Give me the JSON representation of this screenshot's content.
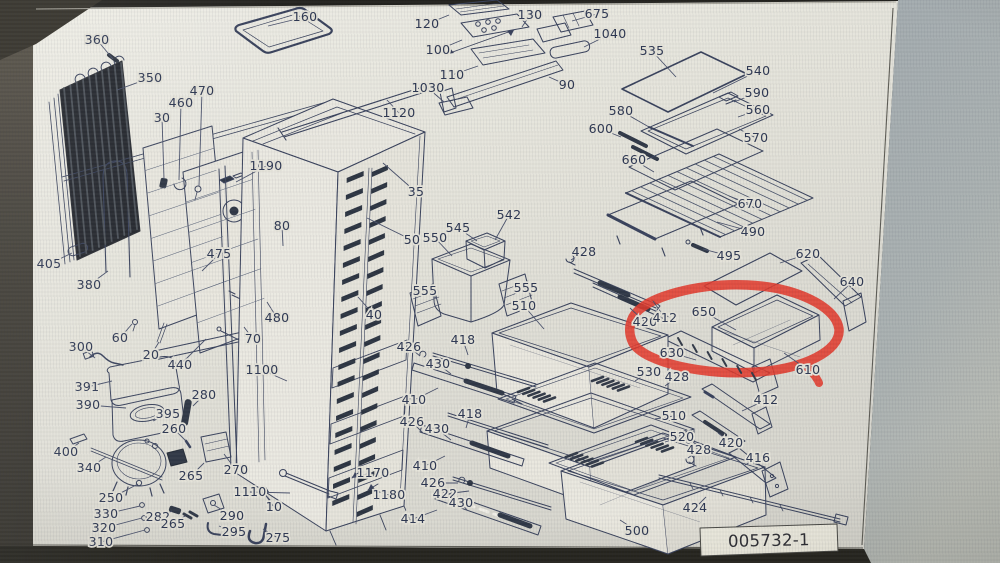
{
  "page": {
    "drawing_number": "005732-1"
  },
  "highlight": {
    "circled_part": "650",
    "color": "#e23a2c"
  },
  "colors": {
    "ink": "#39425c",
    "label_text": "#2d3752",
    "page_paper": "#e7e5dc",
    "wall": "#aab1b3",
    "bezel": "#2a2924"
  },
  "part_labels": [
    {
      "t": "360",
      "x": 97,
      "y": 40,
      "ex": 113,
      "ey": 59
    },
    {
      "t": "350",
      "x": 150,
      "y": 78,
      "ex": 117,
      "ey": 90
    },
    {
      "t": "160",
      "x": 305,
      "y": 17,
      "ex": 268,
      "ey": 26
    },
    {
      "t": "30",
      "x": 162,
      "y": 118,
      "ex": 164,
      "ey": 179
    },
    {
      "t": "460",
      "x": 181,
      "y": 103,
      "ex": 179,
      "ey": 180
    },
    {
      "t": "470",
      "x": 202,
      "y": 91,
      "ex": 199,
      "ey": 186
    },
    {
      "t": "1190",
      "x": 266,
      "y": 166,
      "ex": 236,
      "ey": 182
    },
    {
      "t": "1120",
      "x": 399,
      "y": 113,
      "ex": 387,
      "ey": 100
    },
    {
      "t": "120",
      "x": 427,
      "y": 24,
      "ex": 449,
      "ey": 15
    },
    {
      "t": "100",
      "x": 438,
      "y": 50,
      "ex": 462,
      "ey": 40
    },
    {
      "t": "110",
      "x": 452,
      "y": 75,
      "ex": 478,
      "ey": 66
    },
    {
      "t": "1030",
      "x": 428,
      "y": 88,
      "ex": 444,
      "ey": 102
    },
    {
      "t": "130",
      "x": 530,
      "y": 15,
      "ex": 522,
      "ey": 27
    },
    {
      "t": "675",
      "x": 597,
      "y": 14,
      "ex": 572,
      "ey": 21
    },
    {
      "t": "1040",
      "x": 610,
      "y": 34,
      "ex": 584,
      "ey": 47
    },
    {
      "t": "90",
      "x": 567,
      "y": 85,
      "ex": 549,
      "ey": 77
    },
    {
      "t": "535",
      "x": 652,
      "y": 51,
      "ex": 676,
      "ey": 77
    },
    {
      "t": "540",
      "x": 758,
      "y": 71,
      "ex": 713,
      "ey": 93
    },
    {
      "t": "590",
      "x": 757,
      "y": 93,
      "ex": 734,
      "ey": 102
    },
    {
      "t": "560",
      "x": 758,
      "y": 110,
      "ex": 738,
      "ey": 117
    },
    {
      "t": "580",
      "x": 621,
      "y": 111,
      "ex": 649,
      "ey": 127
    },
    {
      "t": "600",
      "x": 601,
      "y": 129,
      "ex": 621,
      "ey": 137
    },
    {
      "t": "570",
      "x": 756,
      "y": 138,
      "ex": 739,
      "ey": 129
    },
    {
      "t": "660",
      "x": 634,
      "y": 160,
      "ex": 654,
      "ey": 172
    },
    {
      "t": "670",
      "x": 750,
      "y": 204,
      "ex": 729,
      "ey": 196
    },
    {
      "t": "490",
      "x": 753,
      "y": 232,
      "ex": 717,
      "ey": 222
    },
    {
      "t": "495",
      "x": 729,
      "y": 256,
      "ex": 703,
      "ey": 249
    },
    {
      "t": "620",
      "x": 808,
      "y": 254,
      "ex": 780,
      "ey": 263
    },
    {
      "t": "640",
      "x": 852,
      "y": 282,
      "ex": 834,
      "ey": 299
    },
    {
      "t": "650",
      "x": 704,
      "y": 312,
      "ex": 736,
      "ey": 330
    },
    {
      "t": "630",
      "x": 672,
      "y": 353,
      "ex": 696,
      "ey": 360
    },
    {
      "t": "610",
      "x": 808,
      "y": 370,
      "ex": 784,
      "ey": 353
    },
    {
      "t": "35",
      "x": 416,
      "y": 192,
      "ex": 383,
      "ey": 163
    },
    {
      "t": "50",
      "x": 412,
      "y": 240,
      "ex": 367,
      "ey": 218
    },
    {
      "t": "40",
      "x": 374,
      "y": 315,
      "ex": 358,
      "ey": 297
    },
    {
      "t": "80",
      "x": 282,
      "y": 226,
      "ex": 283,
      "ey": 246
    },
    {
      "t": "480",
      "x": 277,
      "y": 318,
      "ex": 267,
      "ey": 302
    },
    {
      "t": "70",
      "x": 253,
      "y": 339,
      "ex": 244,
      "ey": 327
    },
    {
      "t": "1100",
      "x": 262,
      "y": 370,
      "ex": 287,
      "ey": 381
    },
    {
      "t": "1170",
      "x": 373,
      "y": 473,
      "ex": 352,
      "ey": 477
    },
    {
      "t": "1180",
      "x": 389,
      "y": 495,
      "ex": 370,
      "ey": 489
    },
    {
      "t": "405",
      "x": 49,
      "y": 264,
      "ex": 72,
      "ey": 253
    },
    {
      "t": "380",
      "x": 89,
      "y": 285,
      "ex": 108,
      "ey": 271
    },
    {
      "t": "475",
      "x": 219,
      "y": 254,
      "ex": 202,
      "ey": 271
    },
    {
      "t": "300",
      "x": 81,
      "y": 347,
      "ex": 95,
      "ey": 358
    },
    {
      "t": "60",
      "x": 120,
      "y": 338,
      "ex": 132,
      "ey": 324
    },
    {
      "t": "20",
      "x": 151,
      "y": 355,
      "ex": 159,
      "ey": 342
    },
    {
      "t": "440",
      "x": 180,
      "y": 365,
      "ex": 206,
      "ey": 339
    },
    {
      "t": "391",
      "x": 87,
      "y": 387,
      "ex": 112,
      "ey": 381
    },
    {
      "t": "390",
      "x": 88,
      "y": 405,
      "ex": 126,
      "ey": 408
    },
    {
      "t": "395",
      "x": 168,
      "y": 414,
      "ex": 153,
      "ey": 421
    },
    {
      "t": "280",
      "x": 204,
      "y": 395,
      "ex": 193,
      "ey": 406
    },
    {
      "t": "260",
      "x": 174,
      "y": 429,
      "ex": 186,
      "ey": 441
    },
    {
      "t": "400",
      "x": 66,
      "y": 452,
      "ex": 79,
      "ey": 443
    },
    {
      "t": "340",
      "x": 89,
      "y": 468,
      "ex": 106,
      "ey": 457
    },
    {
      "t": "265",
      "x": 191,
      "y": 476,
      "ex": 204,
      "ey": 463
    },
    {
      "t": "270",
      "x": 236,
      "y": 470,
      "ex": 224,
      "ey": 454
    },
    {
      "t": "250",
      "x": 111,
      "y": 498,
      "ex": 138,
      "ey": 484
    },
    {
      "t": "330",
      "x": 106,
      "y": 514,
      "ex": 140,
      "ey": 506
    },
    {
      "t": "320",
      "x": 104,
      "y": 528,
      "ex": 142,
      "ey": 518
    },
    {
      "t": "310",
      "x": 101,
      "y": 542,
      "ex": 145,
      "ey": 530
    },
    {
      "t": "282",
      "x": 158,
      "y": 517,
      "ex": 172,
      "ey": 511
    },
    {
      "t": "265",
      "x": 173,
      "y": 524,
      "ex": 185,
      "ey": 516
    },
    {
      "t": "290",
      "x": 232,
      "y": 516,
      "ex": 214,
      "ey": 505
    },
    {
      "t": "295",
      "x": 234,
      "y": 532,
      "ex": 219,
      "ey": 526
    },
    {
      "t": "1110",
      "x": 250,
      "y": 492,
      "ex": 290,
      "ey": 493
    },
    {
      "t": "10",
      "x": 274,
      "y": 507,
      "ex": 264,
      "ey": 493
    },
    {
      "t": "275",
      "x": 278,
      "y": 538,
      "ex": 263,
      "ey": 529
    },
    {
      "t": "545",
      "x": 458,
      "y": 228,
      "ex": 477,
      "ey": 241
    },
    {
      "t": "550",
      "x": 435,
      "y": 238,
      "ex": 452,
      "ey": 256
    },
    {
      "t": "542",
      "x": 509,
      "y": 215,
      "ex": 495,
      "ey": 240
    },
    {
      "t": "555",
      "x": 425,
      "y": 291,
      "ex": 436,
      "ey": 298
    },
    {
      "t": "555",
      "x": 526,
      "y": 288,
      "ex": 514,
      "ey": 294
    },
    {
      "t": "510",
      "x": 524,
      "y": 306,
      "ex": 544,
      "ey": 329
    },
    {
      "t": "428",
      "x": 584,
      "y": 252,
      "ex": 571,
      "ey": 260
    },
    {
      "t": "420",
      "x": 645,
      "y": 322,
      "ex": 630,
      "ey": 308
    },
    {
      "t": "412",
      "x": 665,
      "y": 318,
      "ex": 653,
      "ey": 301
    },
    {
      "t": "418",
      "x": 463,
      "y": 340,
      "ex": 468,
      "ey": 355
    },
    {
      "t": "426",
      "x": 409,
      "y": 347,
      "ex": 420,
      "ey": 356
    },
    {
      "t": "430",
      "x": 438,
      "y": 364,
      "ex": 451,
      "ey": 374
    },
    {
      "t": "410",
      "x": 414,
      "y": 400,
      "ex": 438,
      "ey": 388
    },
    {
      "t": "418",
      "x": 470,
      "y": 414,
      "ex": 466,
      "ey": 428
    },
    {
      "t": "426",
      "x": 412,
      "y": 422,
      "ex": 423,
      "ey": 433
    },
    {
      "t": "430",
      "x": 437,
      "y": 429,
      "ex": 451,
      "ey": 440
    },
    {
      "t": "410",
      "x": 425,
      "y": 466,
      "ex": 445,
      "ey": 456
    },
    {
      "t": "426",
      "x": 433,
      "y": 483,
      "ex": 458,
      "ey": 483
    },
    {
      "t": "422",
      "x": 445,
      "y": 494,
      "ex": 469,
      "ey": 491
    },
    {
      "t": "430",
      "x": 461,
      "y": 503,
      "ex": 467,
      "ey": 510
    },
    {
      "t": "414",
      "x": 413,
      "y": 519,
      "ex": 437,
      "ey": 510
    },
    {
      "t": "530",
      "x": 649,
      "y": 372,
      "ex": 635,
      "ey": 381
    },
    {
      "t": "428",
      "x": 677,
      "y": 377,
      "ex": 665,
      "ey": 386
    },
    {
      "t": "412",
      "x": 766,
      "y": 400,
      "ex": 742,
      "ey": 411
    },
    {
      "t": "510",
      "x": 674,
      "y": 416,
      "ex": 655,
      "ey": 419
    },
    {
      "t": "520",
      "x": 682,
      "y": 437,
      "ex": 665,
      "ey": 442
    },
    {
      "t": "428",
      "x": 699,
      "y": 450,
      "ex": 688,
      "ey": 458
    },
    {
      "t": "420",
      "x": 731,
      "y": 443,
      "ex": 718,
      "ey": 433
    },
    {
      "t": "416",
      "x": 758,
      "y": 458,
      "ex": 745,
      "ey": 465
    },
    {
      "t": "424",
      "x": 695,
      "y": 508,
      "ex": 706,
      "ey": 497
    },
    {
      "t": "500",
      "x": 637,
      "y": 531,
      "ex": 620,
      "ey": 520
    }
  ]
}
